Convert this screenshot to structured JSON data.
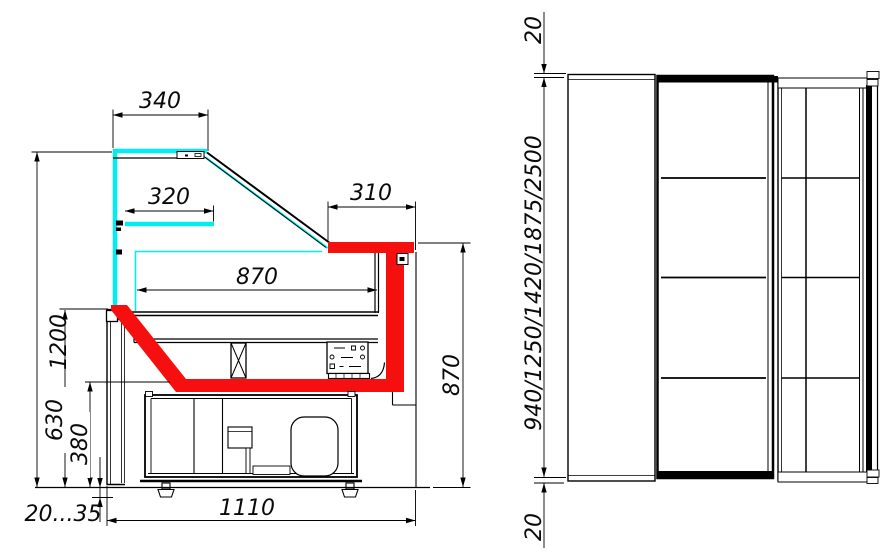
{
  "colors": {
    "glass": "#00EDF2",
    "accent_red": "#F50F0F",
    "ink": "#000000",
    "paper": "#FFFFFF"
  },
  "side_view": {
    "dims": {
      "canopy_depth": "340",
      "shelf_depth": "320",
      "worktop_depth": "310",
      "display_depth": "870",
      "overall_height": "1200",
      "mid_height": "630",
      "base_height": "380",
      "leg_range": "20...35",
      "base_depth": "1110",
      "worktop_height": "870"
    }
  },
  "front_view": {
    "dims": {
      "top_offset": "20",
      "length_options": "940/1250/1420/1875/2500",
      "bottom_offset": "20"
    }
  }
}
